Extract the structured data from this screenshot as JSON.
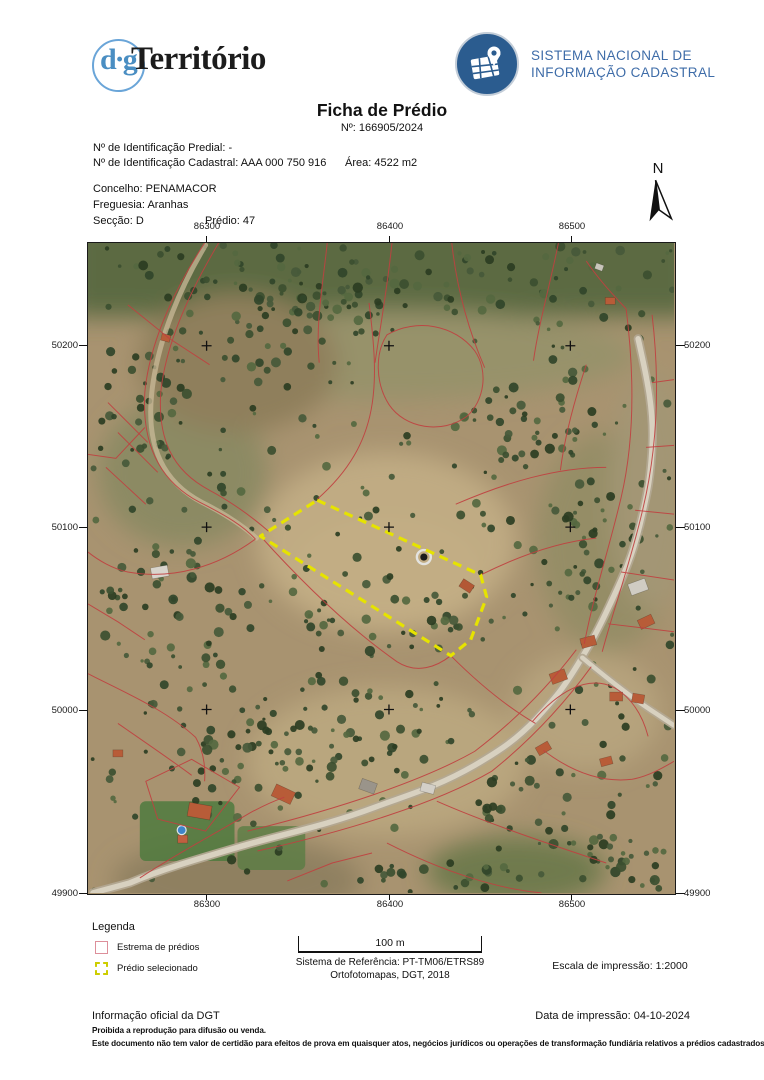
{
  "brand": {
    "dgt": {
      "circle_text": "d·g",
      "wordmark": "Território"
    },
    "snic": {
      "line1": "SISTEMA NACIONAL DE",
      "line2": "INFORMAÇÃO CADASTRAL"
    }
  },
  "title": {
    "heading": "Ficha de Prédio",
    "number": "Nº: 166905/2024"
  },
  "property": {
    "id_predial": {
      "label": "Nº de Identificação Predial:",
      "value": "-"
    },
    "id_cadastral": {
      "label": "Nº de Identificação Cadastral:",
      "value": "AAA 000 750 916"
    },
    "area": {
      "label": "Área:",
      "value": "4522 m2"
    },
    "concelho": {
      "label": "Concelho:",
      "value": "PENAMACOR"
    },
    "freguesia": {
      "label": "Freguesia:",
      "value": "Aranhas"
    },
    "seccao": {
      "label": "Secção:",
      "value": "D"
    },
    "predio": {
      "label": "Prédio:",
      "value": "47"
    }
  },
  "map": {
    "north": "N",
    "x_ticks": [
      "86300",
      "86400",
      "86500"
    ],
    "y_ticks": [
      "50200",
      "50100",
      "50000",
      "49900"
    ]
  },
  "legend": {
    "title": "Legenda",
    "items": [
      {
        "label": "Estrema de prédios"
      },
      {
        "label": "Prédio selecionado"
      }
    ]
  },
  "scale": {
    "bar_label": "100 m",
    "reference": "Sistema de Referência: PT-TM06/ETRS89",
    "source": "Ortofotomapas, DGT, 2018",
    "print_scale": "Escala de impressão: 1:2000"
  },
  "footer": {
    "official": "Informação oficial da DGT",
    "print_date": "Data de impressão: 04-10-2024",
    "warning1": "Proibida a reprodução para difusão ou venda.",
    "warning2": "Este documento não tem valor de certidão para efeitos de prova em quaisquer atos, negócios jurídicos ou operações de transformação fundiária relativos a prédios cadastrados."
  },
  "colors": {
    "boundary_line": "#c04040",
    "selected_parcel": "#e6e300",
    "legend_estrema": "#dd8f9a",
    "legend_selected": "#cdcd00",
    "snic_blue": "#2b5c8f",
    "dgt_blue": "#4a8ec2"
  }
}
